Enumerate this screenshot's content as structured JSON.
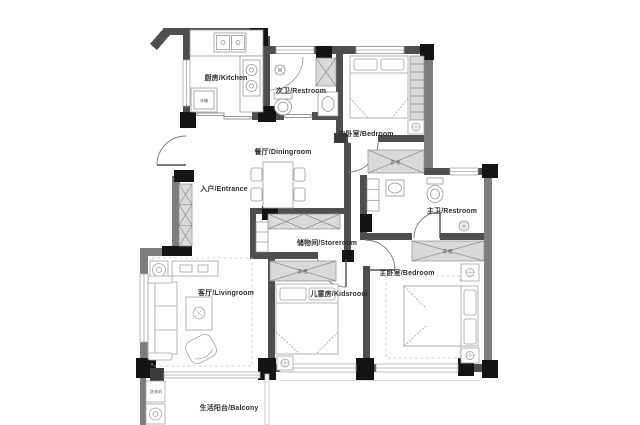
{
  "plan": {
    "rooms": [
      {
        "id": "kitchen",
        "label": "厨房/Kitchen"
      },
      {
        "id": "restroom-secondary",
        "label": "次卫/Restroom"
      },
      {
        "id": "bedroom-secondary",
        "label": "次卧室/Bedroom"
      },
      {
        "id": "dining",
        "label": "餐厅/Diningroom"
      },
      {
        "id": "entrance",
        "label": "入户/Entrance"
      },
      {
        "id": "storeroom",
        "label": "储物间/Storeroom"
      },
      {
        "id": "restroom-master",
        "label": "主卫/Restroom"
      },
      {
        "id": "living",
        "label": "客厅/Livingroom"
      },
      {
        "id": "kids",
        "label": "儿童房/Kidsroom"
      },
      {
        "id": "bedroom-master",
        "label": "主卧室/Bedroom"
      },
      {
        "id": "balcony",
        "label": "生活阳台/Balcony"
      }
    ],
    "fixtures": {
      "wardrobe_label": "衣柜",
      "fridge_label": "冰箱",
      "washer_label": "洗衣机"
    },
    "colors": {
      "wall": "#4f4f4f",
      "wall_light": "#7d7d7d",
      "corner": "#141414",
      "hatch_fill": "#d9d9d9",
      "furniture_line": "#999999",
      "label": "#2e2e2e",
      "background": "#ffffff"
    }
  }
}
